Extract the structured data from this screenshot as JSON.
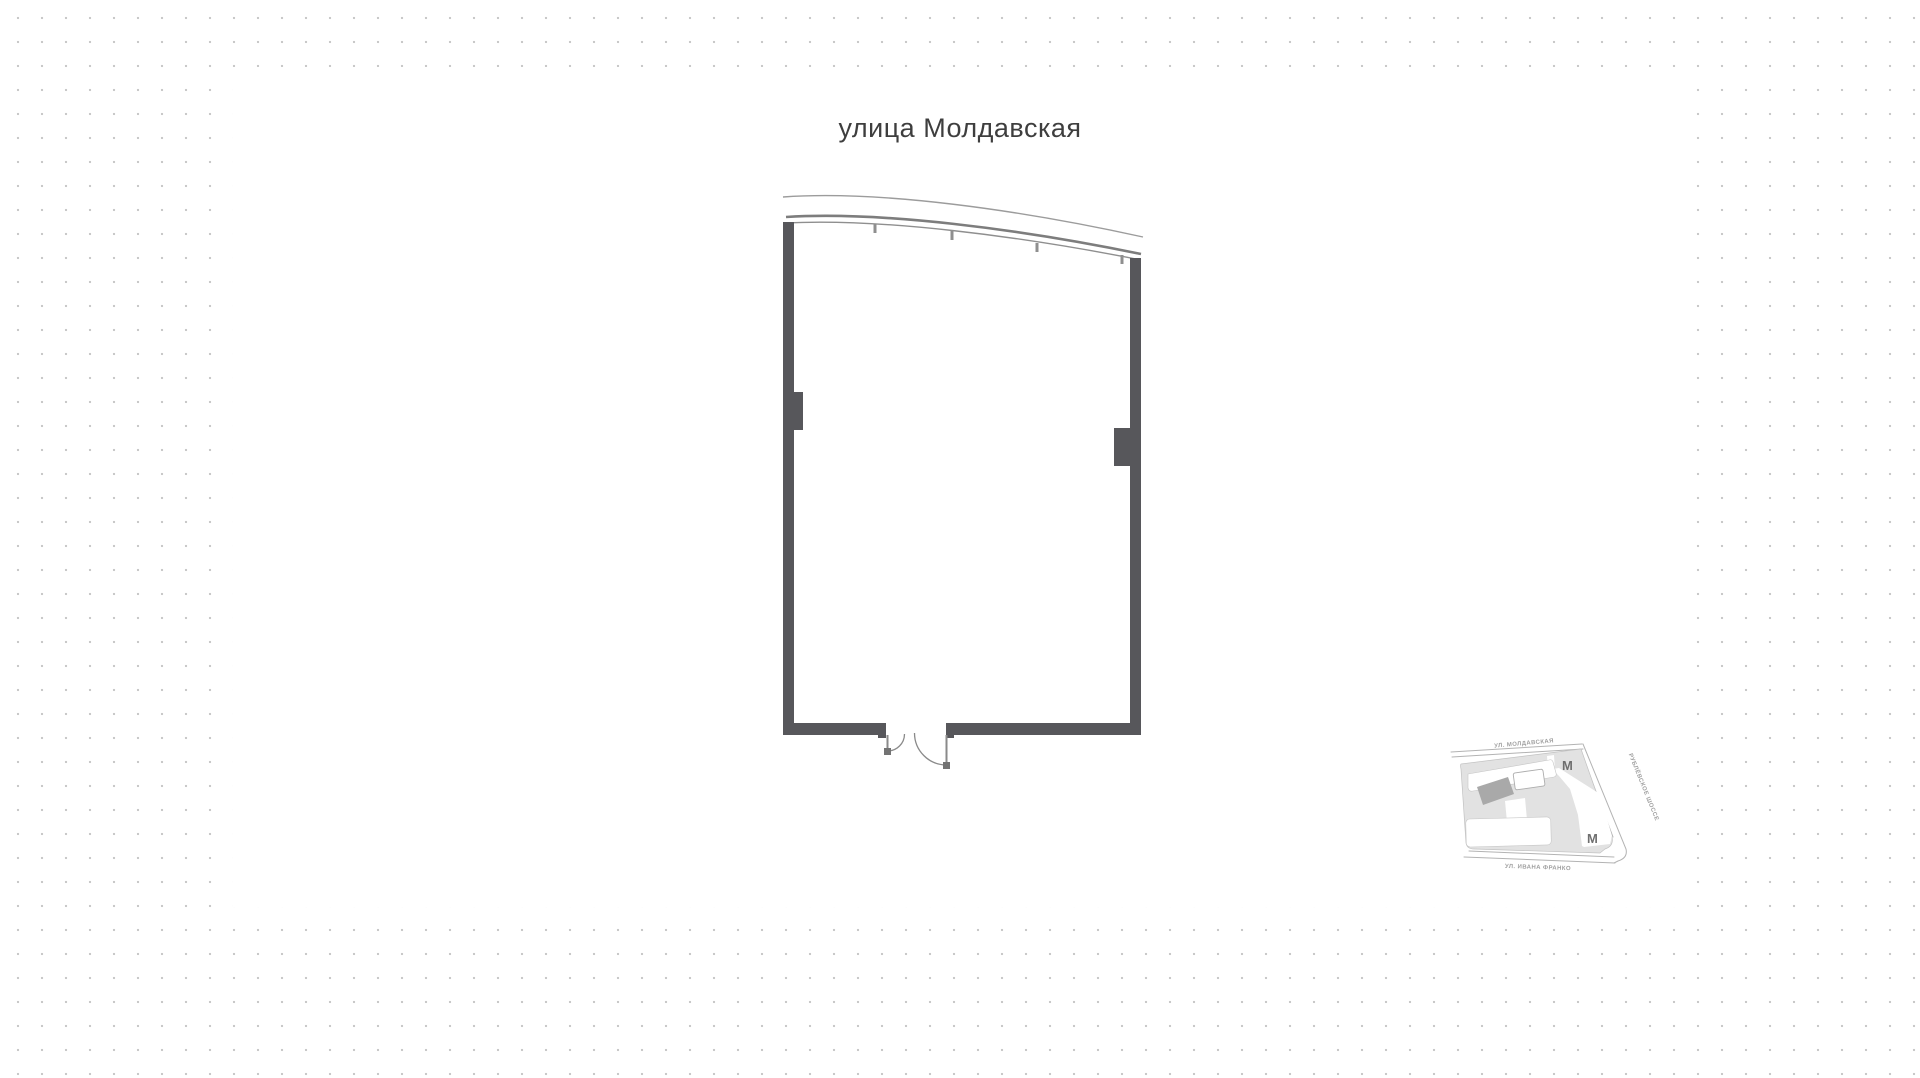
{
  "title": {
    "street_label": "улица Молдавская"
  },
  "colors": {
    "background": "#ffffff",
    "dot": "#c9c9c9",
    "wall": "#57575b",
    "facade_line_outer": "#9c9c9c",
    "facade_line_main": "#7d7d7d",
    "facade_line_inner": "#8f8f8f",
    "door_line": "#8a8a8a",
    "hinge": "#737373",
    "title_text": "#3e3e3e",
    "minimap_block": "#e2e2e2",
    "minimap_road_stroke": "#b3b3b3",
    "minimap_building_highlight": "#a9a9a9",
    "minimap_label": "#a0a0a0",
    "minimap_metro": "#6f6f6f"
  },
  "minimap": {
    "streets": [
      {
        "label": "УЛ. МОЛДАВСКАЯ"
      },
      {
        "label": "РУБЛЁВСКОЕ ШОССЕ"
      },
      {
        "label": "УЛ. ИВАНА ФРАНКО"
      }
    ],
    "metro_label": "М"
  }
}
